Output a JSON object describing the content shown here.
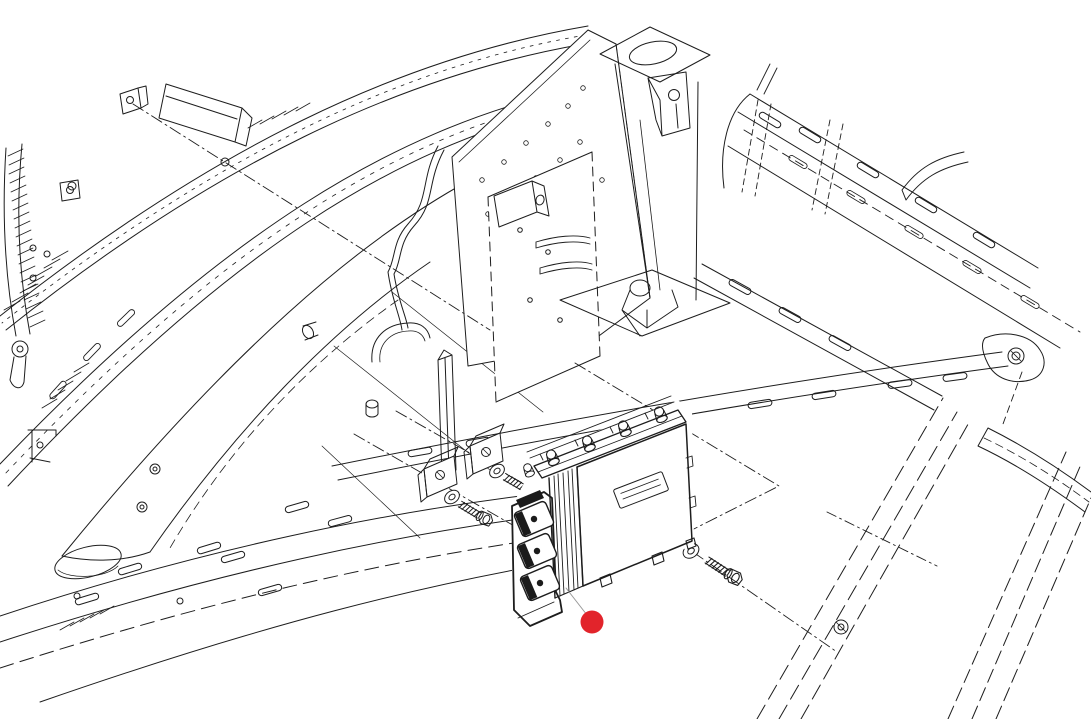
{
  "canvas": {
    "width": 1091,
    "height": 719,
    "background_color": "#ffffff"
  },
  "drawing": {
    "style": "exploded-parts-line-illustration",
    "stroke_color": "#1d1d1d",
    "leader_line_color": "#999999",
    "fill_color": "#ffffff",
    "dark_fill_color": "#1b1b1b"
  },
  "callout_marker": {
    "shape": "filled-circle",
    "color": "#e2242b",
    "cx": 592,
    "cy": 622,
    "r": 11.5
  },
  "parts_depicted": [
    {
      "name": "electronic-control-module",
      "quantity": 1
    },
    {
      "name": "mounting-bracket-clip",
      "quantity": 2
    },
    {
      "name": "flat-washer",
      "quantity": 3
    },
    {
      "name": "hex-head-bolt",
      "quantity": 3
    },
    {
      "name": "chassis-frame-structure",
      "quantity": 1
    }
  ]
}
